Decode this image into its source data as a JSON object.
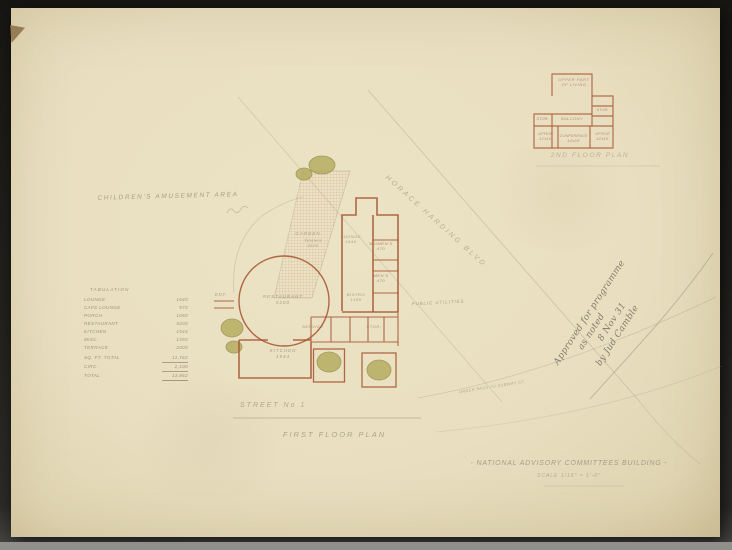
{
  "drawing": {
    "site_label": "CHILDREN'S AMUSEMENT AREA",
    "boulevard_label": "HORACE HARDING BLVD",
    "street_label": "STREET  No 1",
    "underpass_label": "UNDER PASS TO SUBWAY ST.",
    "public_utilities_label": "PUBLIC UTILITIES"
  },
  "captions": {
    "first_floor": "FIRST FLOOR PLAN",
    "second_floor": "2ND FLOOR PLAN"
  },
  "title_block": {
    "title": "- NATIONAL ADVISORY COMMITTEES BUILDING -",
    "scale": "SCALE  1/16\" = 1'-0\""
  },
  "first_floor": {
    "garden": {
      "name": "GARDEN"
    },
    "tennis": {
      "name": "TENNIS",
      "area": "4500"
    },
    "lounge": {
      "name": "LOUNGE",
      "area": "1640"
    },
    "womens_toilet": {
      "name": "WOMEN'S",
      "area": "470"
    },
    "mens_toilet": {
      "name": "MEN'S",
      "area": "470"
    },
    "restaurant": {
      "name": "RESTAURANT",
      "area": "5200"
    },
    "bistro": {
      "name": "BISTRO",
      "area": "1400"
    },
    "kitchen": {
      "name": "KITCHEN",
      "area": "1544"
    },
    "service": {
      "name": "SERVICE"
    },
    "storage": {
      "name": "STOR."
    },
    "entrance": {
      "name": "ENT."
    }
  },
  "second_floor": {
    "upper_part_line1": "UPPER PART",
    "upper_part_line2": "OF LIVING",
    "stor_left": "STOR.",
    "balcony": "BALCONY",
    "stor_right": "STOR.",
    "office_left": {
      "name": "OFFICE",
      "size": "12'x15'"
    },
    "conference": {
      "name": "CONFERENCE",
      "size": "14'x24'"
    },
    "office_right": {
      "name": "OFFICE",
      "size": "12'x15'"
    }
  },
  "tabulation": {
    "header": "TABULATION",
    "rows": [
      {
        "label": "LOUNGE",
        "value": "1640"
      },
      {
        "label": "CAFE LOUNGE",
        "value": "970"
      },
      {
        "label": "PORCH",
        "value": "1050"
      },
      {
        "label": "RESTAURANT",
        "value": "5200"
      },
      {
        "label": "KITCHEN",
        "value": "1544"
      },
      {
        "label": "MISC.",
        "value": "1350"
      },
      {
        "label": "TERRACE",
        "value": "2000"
      },
      {
        "label": "SQ. FT. TOTAL",
        "value": "11,762"
      },
      {
        "label": "CIRC.",
        "value": "2,100"
      },
      {
        "label": "TOTAL",
        "value": "13,862"
      }
    ]
  },
  "approval_note": {
    "lines": [
      "Approved for programme",
      "as noted",
      "8 Nov 31",
      "by Jud Camble"
    ]
  },
  "colors": {
    "ink_red": "#a5522f",
    "pencil": "#8d8370",
    "tree_green": "#b2aa5c",
    "paper": "#e9dfc0"
  }
}
